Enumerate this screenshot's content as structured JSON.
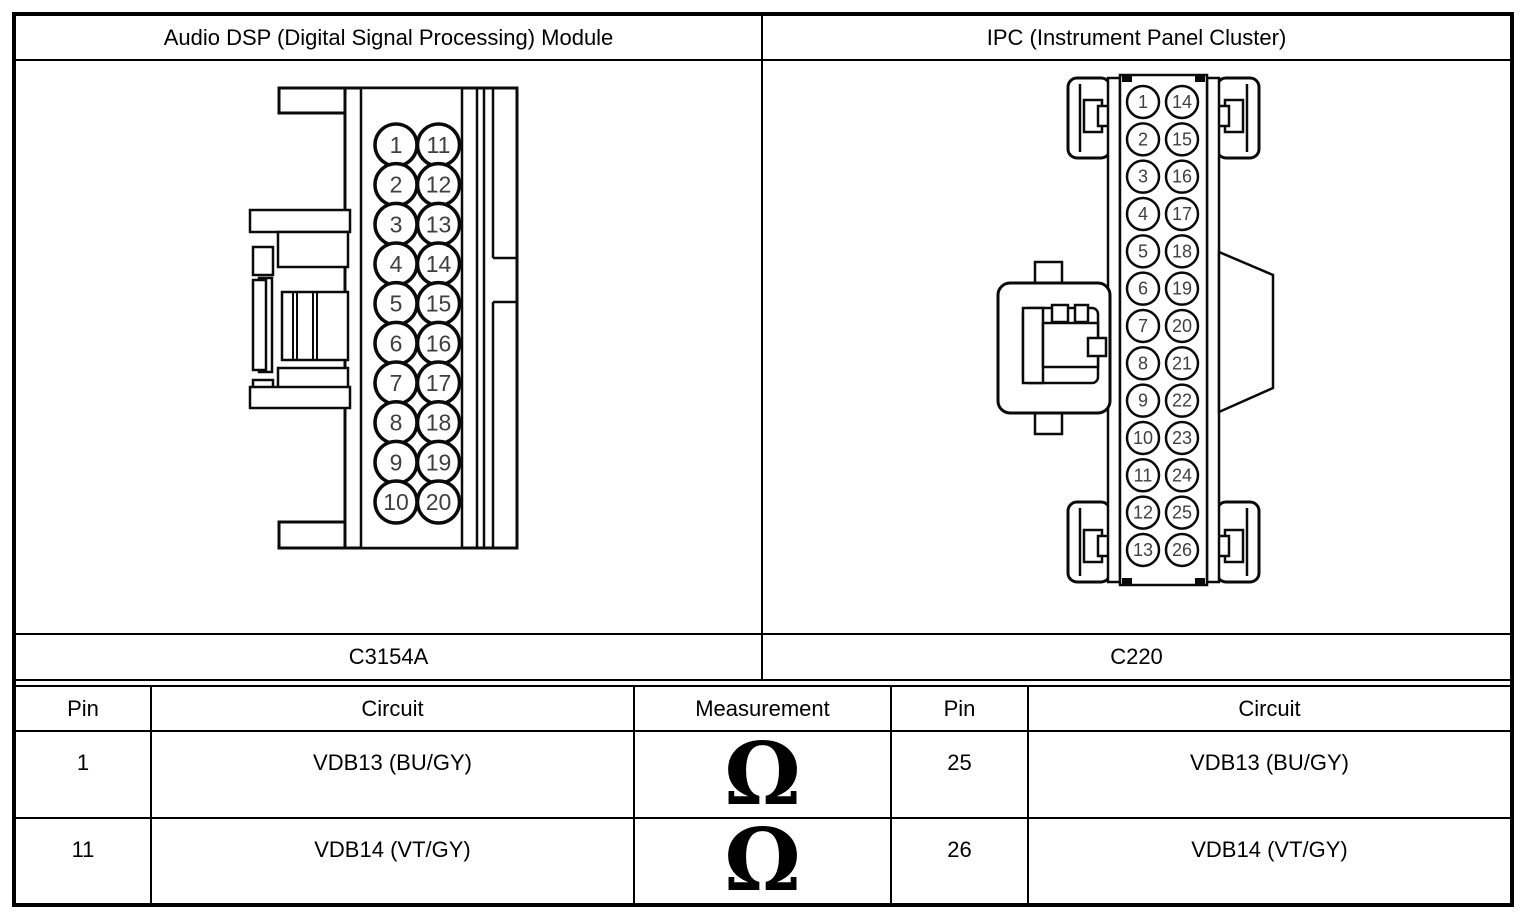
{
  "header": {
    "left_title": "Audio DSP (Digital Signal Processing) Module",
    "right_title": "IPC (Instrument Panel Cluster)"
  },
  "connectors": {
    "left": {
      "name": "Audio DSP module connector",
      "label": "C3154A",
      "pin_columns": [
        [
          1,
          2,
          3,
          4,
          5,
          6,
          7,
          8,
          9,
          10
        ],
        [
          11,
          12,
          13,
          14,
          15,
          16,
          17,
          18,
          19,
          20
        ]
      ]
    },
    "right": {
      "name": "Instrument Panel Cluster connector",
      "label": "C220",
      "pin_columns": [
        [
          1,
          2,
          3,
          4,
          5,
          6,
          7,
          8,
          9,
          10,
          11,
          12,
          13
        ],
        [
          14,
          15,
          16,
          17,
          18,
          19,
          20,
          21,
          22,
          23,
          24,
          25,
          26
        ]
      ]
    }
  },
  "table": {
    "headers": [
      "Pin",
      "Circuit",
      "Measurement",
      "Pin",
      "Circuit"
    ],
    "rows": [
      {
        "left_pin": "1",
        "left_circuit": "VDB13 (BU/GY)",
        "measurement": "Ω",
        "right_pin": "25",
        "right_circuit": "VDB13 (BU/GY)"
      },
      {
        "left_pin": "11",
        "left_circuit": "VDB14 (VT/GY)",
        "measurement": "Ω",
        "right_pin": "26",
        "right_circuit": "VDB14 (VT/GY)"
      }
    ]
  },
  "colors": {
    "line": "#000000",
    "pin_number_text": "#3f3f3f",
    "background": "#ffffff"
  }
}
